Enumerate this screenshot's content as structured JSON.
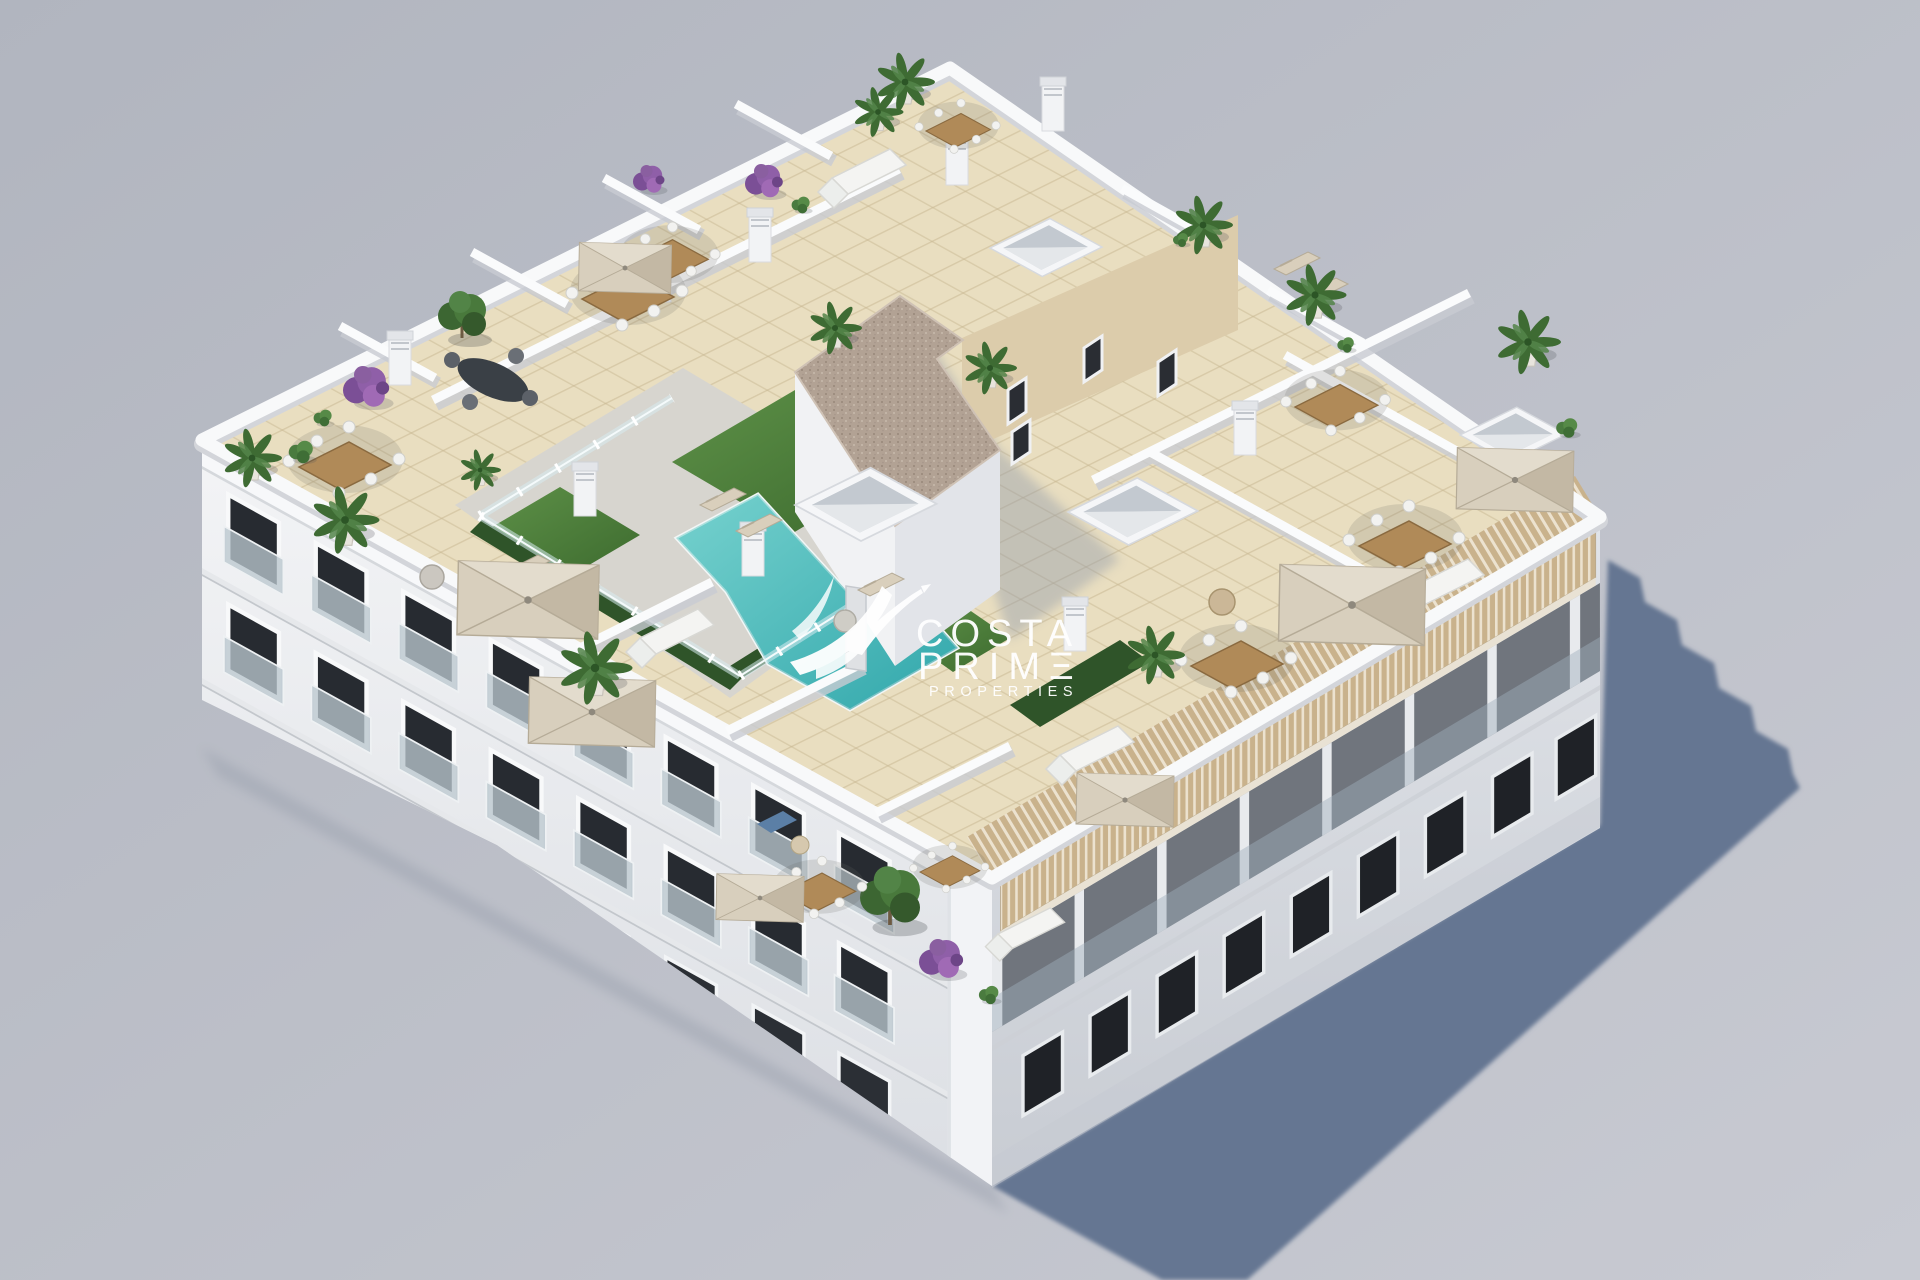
{
  "meta": {
    "width": 1920,
    "height": 1280,
    "kind": "aerial 3D architectural render of apartment building rooftop"
  },
  "watermark": {
    "line1": "COSTA",
    "line2": "PRIMΞ",
    "line3": "PROPERTIES",
    "color": "#ffffff",
    "logo_icon": "hummingbird-swoosh"
  },
  "palette": {
    "background_top": "#b1b5bf",
    "background_bottom": "#c8cad2",
    "ground_shadow": "#657692",
    "building_white": "#f1f2f5",
    "facade_shaded": "#d7dbe1",
    "roof_tile": "#e9dec0",
    "tile_line": "#c8b892",
    "deck": "#d7d5cf",
    "pool_water": "#4cc0c1",
    "pool_deep": "#2fa9ad",
    "grass": "#4e8040",
    "hedge": "#2f5429",
    "gravel_roof": "#b2a294",
    "umbrella": "#d8cfbd",
    "wood": "#ad8a5c",
    "pergola_wood": "#c9b28c",
    "window_glass": "#23262c",
    "plant_green": "#3e6b33",
    "plant_purple": "#8a5fa0"
  },
  "scene": {
    "rooftop_features": [
      "swimming pool",
      "glass pool fence",
      "artificial grass",
      "sun loungers",
      "parasols",
      "dining sets",
      "outdoor sofas",
      "potted palms",
      "bougainvillea planters",
      "stair core with gravel roof",
      "skylight boxes",
      "chimneys",
      "wood louver pergola",
      "penthouse terraces"
    ]
  }
}
